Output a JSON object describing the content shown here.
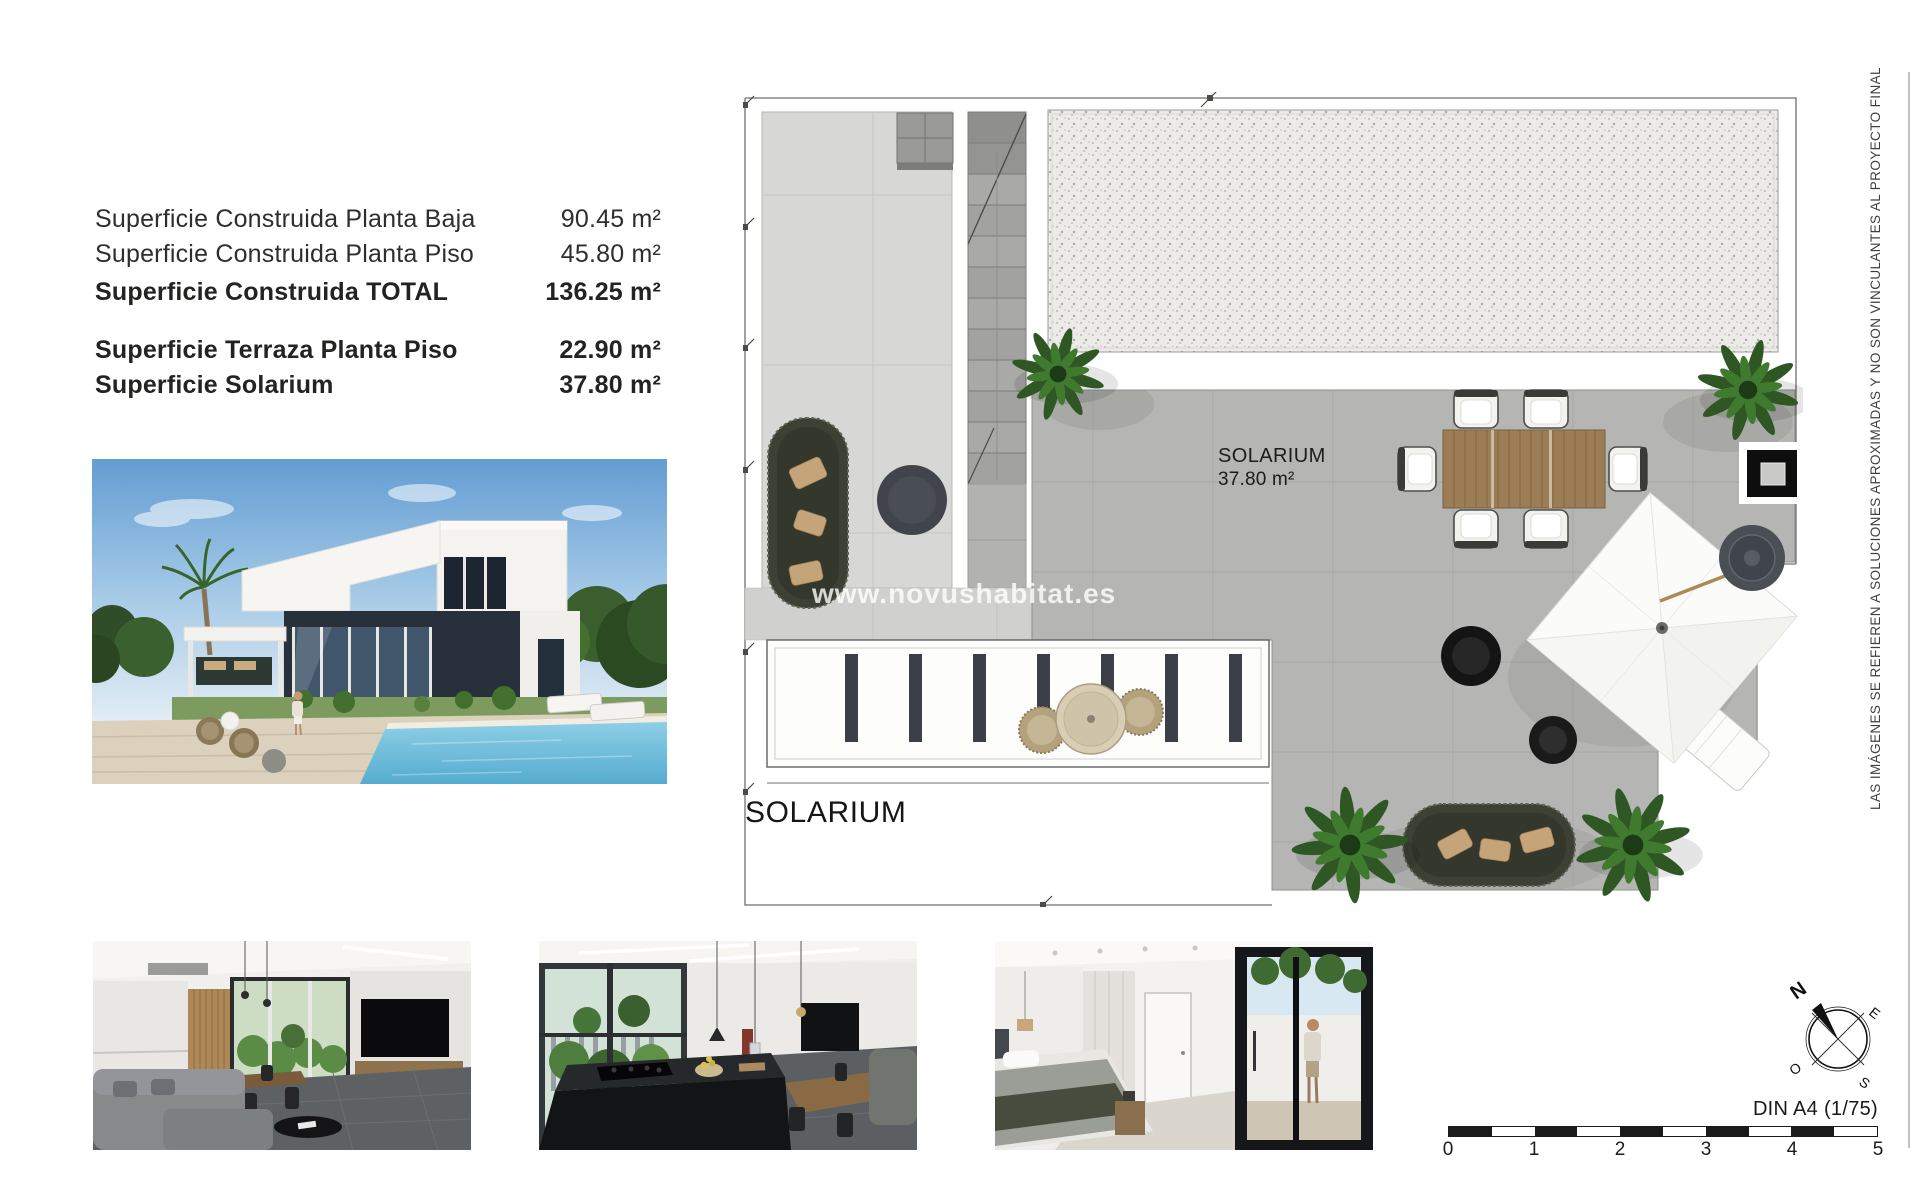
{
  "surfaces": {
    "rows": [
      {
        "label": "Superficie Construida Planta Baja",
        "value": "90.45 m²"
      },
      {
        "label": "Superficie Construida Planta Piso",
        "value": "45.80 m²"
      },
      {
        "label": "Superficie Construida TOTAL",
        "value": "136.25 m²"
      },
      {
        "label": "Superficie Terraza Planta Piso",
        "value": "22.90 m²"
      },
      {
        "label": "Superficie Solarium",
        "value": "37.80 m²"
      }
    ]
  },
  "plan": {
    "section_title": "SOLARIUM",
    "room_label": "SOLARIUM",
    "room_area": "37.80 m²",
    "watermark": "www.novushabitat.es"
  },
  "disclaimer": "LAS IMÁGENES SE REFIEREN A SOLUCIONES APROXIMADAS Y NO SON VINCULANTES AL PROYECTO FINAL",
  "compass": {
    "north": "N",
    "east": "E",
    "west": "O",
    "south": "S"
  },
  "scalebar": {
    "sheet_format": "DIN A4 (1/75)",
    "ticks": [
      "0",
      "1",
      "2",
      "3",
      "4",
      "5"
    ]
  },
  "colors": {
    "terrace_gray": "#b5b5b3",
    "light_tile_gray": "#d7d7d5",
    "furniture_olive": "#3d4035",
    "plant_green": "#3f7a2f",
    "pool_blue": "#7cc4de"
  }
}
